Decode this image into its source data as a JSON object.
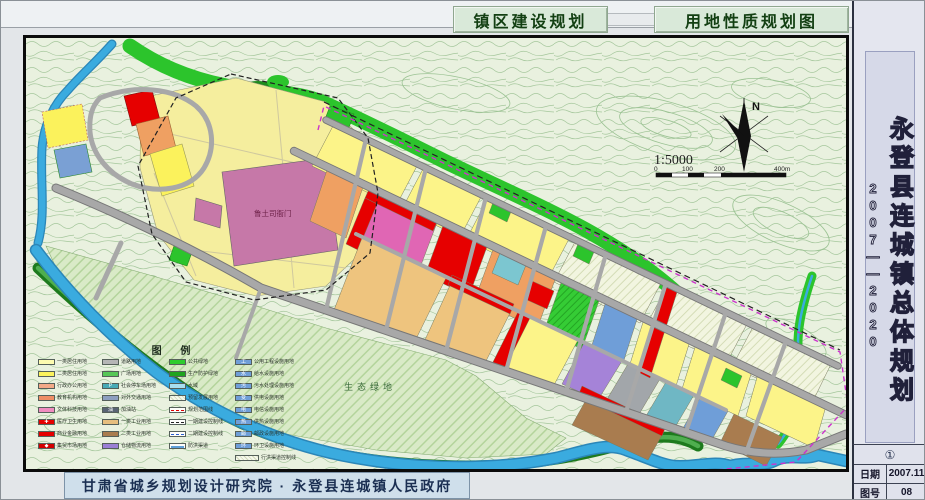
{
  "header": {
    "left_title": "镇区建设规划",
    "right_title": "用地性质规划图"
  },
  "sidebar": {
    "title": "永登县连城镇总体规划",
    "years": "2007——2020",
    "stamp": "①",
    "info": [
      {
        "label": "日期",
        "value": "2007.11"
      },
      {
        "label": "图号",
        "value": "08"
      }
    ]
  },
  "footer": {
    "institution": "甘肃省城乡规划设计研究院 · 永登县连城镇人民政府"
  },
  "map": {
    "labels": {
      "historic_site": "鲁土司衙门",
      "eco_green": "生态绿地"
    },
    "compass": {
      "north": "N"
    },
    "scale": {
      "ratio": "1:5000",
      "bar_labels": [
        "0",
        "100",
        "200",
        "400m"
      ]
    }
  },
  "legend": {
    "title": "图    例",
    "columns": [
      [
        {
          "label": "一类居住用地",
          "type": "solid",
          "color": "#fdfbb0"
        },
        {
          "label": "二类居住用地",
          "type": "solid",
          "color": "#fbf25c"
        },
        {
          "label": "行政办公用地",
          "type": "solid",
          "color": "#f2a988"
        },
        {
          "label": "教育机构用地",
          "type": "solid",
          "color": "#ee8e66"
        },
        {
          "label": "文体科技用地",
          "type": "solid",
          "color": "#f08cc0"
        },
        {
          "label": "医疗卫生用地",
          "type": "solid",
          "color": "#e60000",
          "glyph": "✚"
        },
        {
          "label": "商业金融用地",
          "type": "solid",
          "color": "#e60000"
        },
        {
          "label": "集贸市场用地",
          "type": "solid",
          "color": "#d40000",
          "glyph": "◆"
        }
      ],
      [
        {
          "label": "道路用地",
          "type": "solid",
          "color": "#b5b5b5"
        },
        {
          "label": "广场用地",
          "type": "solid",
          "color": "#57c757"
        },
        {
          "label": "社会停车场用地",
          "type": "solid",
          "color": "#49aab6",
          "glyph": "P"
        },
        {
          "label": "对外交通用地",
          "type": "solid",
          "color": "#8d9fc0"
        },
        {
          "label": "加油站",
          "type": "solid",
          "color": "#5a6474",
          "glyph": "油"
        },
        {
          "label": "一类工业用地",
          "type": "solid",
          "color": "#e6be7e"
        },
        {
          "label": "二类工业用地",
          "type": "solid",
          "color": "#a97c4f"
        },
        {
          "label": "仓储物流用地",
          "type": "solid",
          "color": "#9a7fd4"
        }
      ],
      [
        {
          "label": "公共绿地",
          "type": "solid",
          "color": "#2ecc2e"
        },
        {
          "label": "生产防护绿地",
          "type": "solid",
          "color": "#1fa41f"
        },
        {
          "label": "水域",
          "type": "solid",
          "color": "#a8dff0"
        },
        {
          "label": "预留发展用地",
          "type": "hatch"
        },
        {
          "label": "规划范围线",
          "type": "line",
          "line": "red"
        },
        {
          "label": "一期建设控制线",
          "type": "line",
          "line": "black"
        },
        {
          "label": "二期建设控制线",
          "type": "line",
          "line": "blue"
        },
        {
          "label": "防洪渠道",
          "type": "line",
          "line": "bsol"
        }
      ],
      [
        {
          "label": "公用工程设施用地",
          "type": "solid",
          "color": "#6f9ed8",
          "glyph": "工"
        },
        {
          "label": "给水设施用地",
          "type": "solid",
          "color": "#6f9ed8",
          "glyph": "水"
        },
        {
          "label": "污水处理设施用地",
          "type": "solid",
          "color": "#6f9ed8",
          "glyph": "污"
        },
        {
          "label": "供电设施用地",
          "type": "solid",
          "color": "#6f9ed8",
          "glyph": "变"
        },
        {
          "label": "电信设施用地",
          "type": "solid",
          "color": "#6f9ed8",
          "glyph": "电"
        },
        {
          "label": "供热设施用地",
          "type": "solid",
          "color": "#6f9ed8",
          "glyph": "热"
        },
        {
          "label": "邮政设施用地",
          "type": "solid",
          "color": "#6f9ed8",
          "glyph": "邮"
        },
        {
          "label": "环卫设施用地",
          "type": "solid",
          "color": "#6f9ed8",
          "glyph": "环"
        },
        {
          "label": "行洪渠道控制线",
          "type": "hatch-wide"
        }
      ]
    ]
  },
  "colors": {
    "water": "#3aabdf",
    "green_public": "#2cc42c",
    "green_dark": "#1d7a1d",
    "residential": "#fcf489",
    "commercial_red": "#e60000",
    "market_magenta": "#e066b4",
    "historic_mauve": "#c678a8",
    "industry_tan": "#eec47e",
    "industry_brown": "#a97c4f",
    "warehouse_purple": "#a583d8",
    "road_gray": "#a8a8a8"
  }
}
